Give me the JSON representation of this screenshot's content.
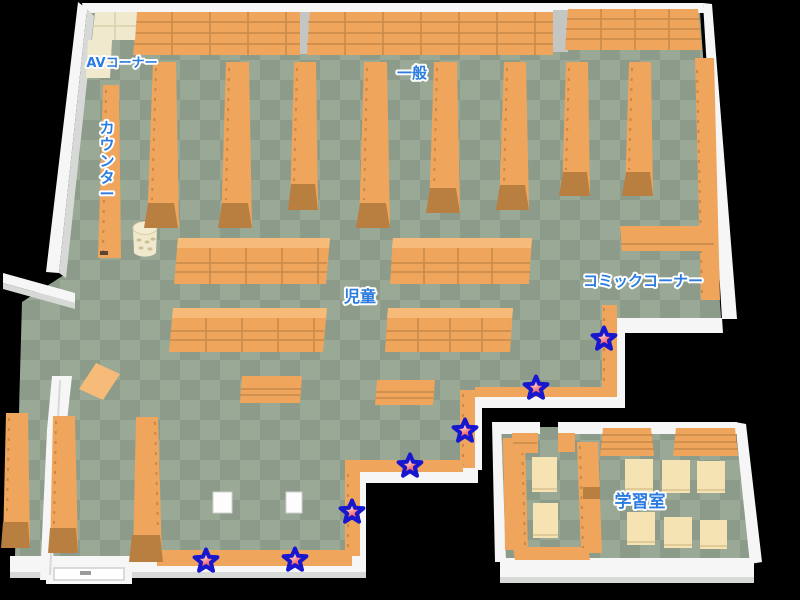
{
  "scene": {
    "type": "library-floor-map",
    "width": 800,
    "height": 600,
    "background": "#000000"
  },
  "labels": {
    "av_corner": "AVコーナー",
    "counter": "カウンター",
    "general": "一般",
    "children": "児童",
    "comic_corner": "コミックコーナー",
    "study_room": "学習室"
  },
  "colors": {
    "background": "#000000",
    "floor_light": "#9aa896",
    "floor_dark": "#8d9c8a",
    "shelf": "#efa55c",
    "shelf_top": "#f6bb78",
    "shelf_line": "#c9894a",
    "shelf_base": "#b97f41",
    "wall_top": "#f6f6f6",
    "wall_face": "#d6d9d6",
    "cream": "#f1e9cd",
    "table_cream": "#f5e3b4",
    "label_blue": "#2b7ce0",
    "label_outline": "#ffffff",
    "star_red": "#e83030",
    "star_highlight": "#ffd2d2",
    "star_outline": "#1717cf"
  },
  "stars": {
    "count": 7,
    "positions": [
      {
        "x": 604,
        "y": 339
      },
      {
        "x": 536,
        "y": 388
      },
      {
        "x": 465,
        "y": 431
      },
      {
        "x": 410,
        "y": 466
      },
      {
        "x": 352,
        "y": 512
      },
      {
        "x": 295,
        "y": 560
      },
      {
        "x": 206,
        "y": 561
      }
    ]
  }
}
